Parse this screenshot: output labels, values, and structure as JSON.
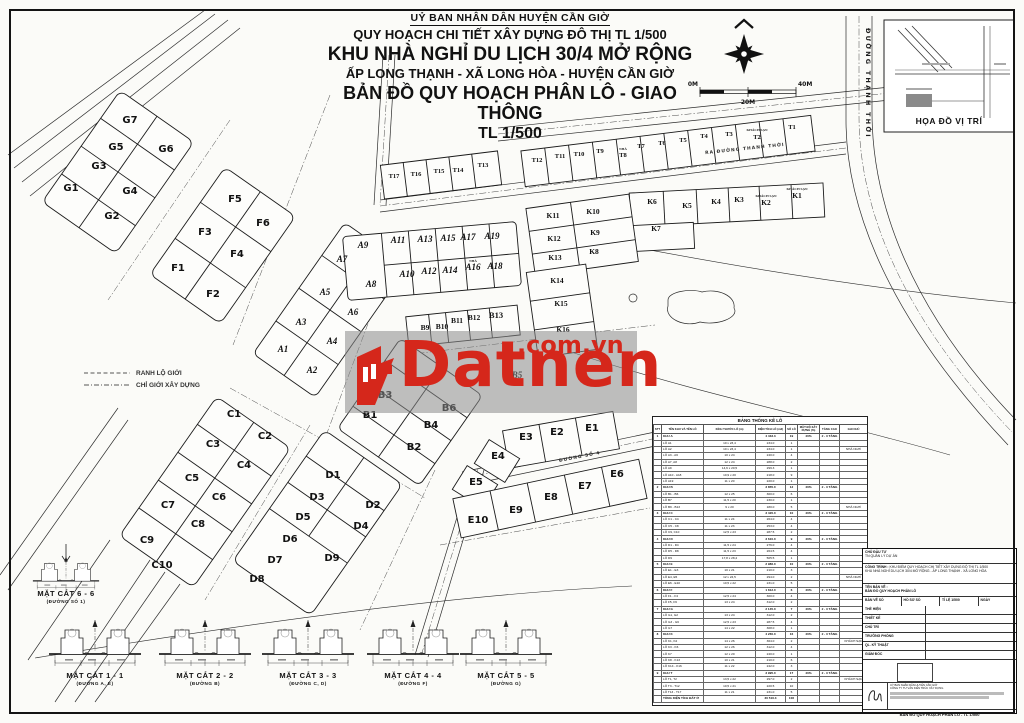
{
  "header": {
    "l1": "UỶ BAN NHÂN DÂN HUYỆN CẦN GIỜ",
    "l2": "QUY HOẠCH CHI TIẾT XÂY DỰNG ĐÔ THỊ TL 1/500",
    "l3": "KHU NHÀ NGHỈ DU LỊCH 30/4 MỞ RỘNG",
    "l4": "ẤP LONG THẠNH - XÃ LONG HÒA - HUYỆN CẦN GIỜ",
    "l5": "BẢN ĐỒ QUY HOẠCH PHÂN LÔ - GIAO THÔNG",
    "l6": "TL 1/500"
  },
  "scale": {
    "left": "0M",
    "mid": "20M",
    "right": "40M"
  },
  "inset": {
    "title": "HỌA ĐỒ VỊ TRÍ"
  },
  "legend": {
    "items": [
      "RANH LỘ GIỚI",
      "CHỈ GIỚI XÂY DỰNG"
    ]
  },
  "watermark": {
    "brand": "Datnen",
    "suffix": ".com.vn",
    "color": "#d5271b"
  },
  "map": {
    "roads": {
      "v": "ĐƯỜNG THẠNH THỚI",
      "top": "RA ĐƯỜNG THANH THỚI",
      "s4": "ĐƯỜNG SỐ 4"
    },
    "notes": [
      {
        "t": "KHÁCH SẠN",
        "x": 757,
        "y": 131
      },
      {
        "t": "KHÁCH SẠN",
        "x": 766,
        "y": 197
      },
      {
        "t": "KHÁCH SẠN",
        "x": 797,
        "y": 190
      },
      {
        "t": "NHÀ",
        "x": 623,
        "y": 150
      },
      {
        "t": "NHÀ",
        "x": 473,
        "y": 262
      }
    ],
    "lots": [
      {
        "t": "G1",
        "x": 71,
        "y": 191
      },
      {
        "t": "G2",
        "x": 112,
        "y": 219
      },
      {
        "t": "G3",
        "x": 99,
        "y": 169
      },
      {
        "t": "G4",
        "x": 130,
        "y": 194
      },
      {
        "t": "G5",
        "x": 116,
        "y": 150
      },
      {
        "t": "G6",
        "x": 166,
        "y": 152
      },
      {
        "t": "G7",
        "x": 130,
        "y": 123
      },
      {
        "t": "F1",
        "x": 178,
        "y": 271
      },
      {
        "t": "F2",
        "x": 213,
        "y": 297
      },
      {
        "t": "F3",
        "x": 205,
        "y": 235
      },
      {
        "t": "F4",
        "x": 237,
        "y": 257
      },
      {
        "t": "F5",
        "x": 235,
        "y": 202
      },
      {
        "t": "F6",
        "x": 263,
        "y": 226
      },
      {
        "t": "A1",
        "x": 283,
        "y": 352,
        "c": "la"
      },
      {
        "t": "A2",
        "x": 312,
        "y": 373,
        "c": "la"
      },
      {
        "t": "A3",
        "x": 301,
        "y": 325,
        "c": "la"
      },
      {
        "t": "A4",
        "x": 332,
        "y": 344,
        "c": "la"
      },
      {
        "t": "A5",
        "x": 325,
        "y": 295,
        "c": "la"
      },
      {
        "t": "A6",
        "x": 353,
        "y": 315,
        "c": "la"
      },
      {
        "t": "A7",
        "x": 342,
        "y": 262,
        "c": "la"
      },
      {
        "t": "A8",
        "x": 371,
        "y": 287,
        "c": "la"
      },
      {
        "t": "A9",
        "x": 363,
        "y": 248,
        "c": "la"
      },
      {
        "t": "A10",
        "x": 407,
        "y": 277,
        "c": "la"
      },
      {
        "t": "A11",
        "x": 398,
        "y": 243,
        "c": "la"
      },
      {
        "t": "A12",
        "x": 429,
        "y": 274,
        "c": "la"
      },
      {
        "t": "A13",
        "x": 425,
        "y": 242,
        "c": "la"
      },
      {
        "t": "A14",
        "x": 450,
        "y": 273,
        "c": "la"
      },
      {
        "t": "A15",
        "x": 448,
        "y": 241,
        "c": "la"
      },
      {
        "t": "A16",
        "x": 473,
        "y": 270,
        "c": "la"
      },
      {
        "t": "A17",
        "x": 468,
        "y": 240,
        "c": "la"
      },
      {
        "t": "A18",
        "x": 495,
        "y": 269,
        "c": "la"
      },
      {
        "t": "A19",
        "x": 492,
        "y": 239,
        "c": "la"
      },
      {
        "t": "B1",
        "x": 370,
        "y": 418
      },
      {
        "t": "B2",
        "x": 414,
        "y": 450
      },
      {
        "t": "B3",
        "x": 385,
        "y": 398
      },
      {
        "t": "B4",
        "x": 431,
        "y": 428
      },
      {
        "t": "B5",
        "x": 517,
        "y": 378,
        "c": "la"
      },
      {
        "t": "B6",
        "x": 449,
        "y": 411
      },
      {
        "t": "B7",
        "x": 413,
        "y": 352,
        "c": "la"
      },
      {
        "t": "B9",
        "x": 425,
        "y": 330,
        "c": "lk"
      },
      {
        "t": "B10",
        "x": 442,
        "y": 329,
        "c": "lk"
      },
      {
        "t": "B11",
        "x": 457,
        "y": 323,
        "c": "lk"
      },
      {
        "t": "B12",
        "x": 474,
        "y": 320,
        "c": "lk"
      },
      {
        "t": "B13",
        "x": 496,
        "y": 318,
        "c": "lb13"
      },
      {
        "t": "C1",
        "x": 234,
        "y": 417
      },
      {
        "t": "C2",
        "x": 265,
        "y": 439
      },
      {
        "t": "C3",
        "x": 213,
        "y": 447
      },
      {
        "t": "C4",
        "x": 244,
        "y": 468
      },
      {
        "t": "C5",
        "x": 192,
        "y": 481
      },
      {
        "t": "C6",
        "x": 219,
        "y": 500
      },
      {
        "t": "C7",
        "x": 168,
        "y": 508
      },
      {
        "t": "C8",
        "x": 198,
        "y": 527
      },
      {
        "t": "C9",
        "x": 147,
        "y": 543
      },
      {
        "t": "C10",
        "x": 162,
        "y": 568
      },
      {
        "t": "D1",
        "x": 333,
        "y": 478
      },
      {
        "t": "D2",
        "x": 373,
        "y": 508
      },
      {
        "t": "D3",
        "x": 317,
        "y": 500
      },
      {
        "t": "D4",
        "x": 361,
        "y": 529
      },
      {
        "t": "D5",
        "x": 303,
        "y": 520
      },
      {
        "t": "D6",
        "x": 290,
        "y": 542
      },
      {
        "t": "D7",
        "x": 275,
        "y": 563
      },
      {
        "t": "D8",
        "x": 257,
        "y": 582
      },
      {
        "t": "D9",
        "x": 332,
        "y": 561
      },
      {
        "t": "E1",
        "x": 592,
        "y": 431
      },
      {
        "t": "E2",
        "x": 557,
        "y": 435
      },
      {
        "t": "E3",
        "x": 526,
        "y": 440
      },
      {
        "t": "E4",
        "x": 498,
        "y": 459
      },
      {
        "t": "E5",
        "x": 476,
        "y": 485
      },
      {
        "t": "E6",
        "x": 617,
        "y": 477
      },
      {
        "t": "E7",
        "x": 585,
        "y": 489
      },
      {
        "t": "E8",
        "x": 551,
        "y": 500
      },
      {
        "t": "E9",
        "x": 516,
        "y": 513
      },
      {
        "t": "E10",
        "x": 478,
        "y": 523
      },
      {
        "t": "K1",
        "x": 797,
        "y": 198,
        "c": "lk"
      },
      {
        "t": "K2",
        "x": 766,
        "y": 205,
        "c": "lk"
      },
      {
        "t": "K3",
        "x": 739,
        "y": 202,
        "c": "lk"
      },
      {
        "t": "K4",
        "x": 716,
        "y": 204,
        "c": "lk"
      },
      {
        "t": "K5",
        "x": 687,
        "y": 208,
        "c": "lk"
      },
      {
        "t": "K6",
        "x": 652,
        "y": 204,
        "c": "lk"
      },
      {
        "t": "K7",
        "x": 656,
        "y": 231,
        "c": "lk"
      },
      {
        "t": "K8",
        "x": 594,
        "y": 254,
        "c": "lk"
      },
      {
        "t": "K9",
        "x": 595,
        "y": 235,
        "c": "lk"
      },
      {
        "t": "K10",
        "x": 593,
        "y": 214,
        "c": "lk"
      },
      {
        "t": "K11",
        "x": 553,
        "y": 218,
        "c": "lk"
      },
      {
        "t": "K12",
        "x": 554,
        "y": 241,
        "c": "lk"
      },
      {
        "t": "K13",
        "x": 555,
        "y": 260,
        "c": "lk"
      },
      {
        "t": "K14",
        "x": 557,
        "y": 283,
        "c": "lk"
      },
      {
        "t": "K15",
        "x": 561,
        "y": 306,
        "c": "lk"
      },
      {
        "t": "K16",
        "x": 563,
        "y": 332,
        "c": "lk"
      },
      {
        "t": "T1",
        "x": 792,
        "y": 129,
        "c": "lt"
      },
      {
        "t": "T2",
        "x": 757,
        "y": 139,
        "c": "lt"
      },
      {
        "t": "T3",
        "x": 729,
        "y": 136,
        "c": "lt"
      },
      {
        "t": "T4",
        "x": 704,
        "y": 138,
        "c": "lt"
      },
      {
        "t": "T5",
        "x": 683,
        "y": 142,
        "c": "lt"
      },
      {
        "t": "T6",
        "x": 662,
        "y": 145,
        "c": "lt"
      },
      {
        "t": "T7",
        "x": 641,
        "y": 148,
        "c": "lt"
      },
      {
        "t": "T8",
        "x": 623,
        "y": 157,
        "c": "lt"
      },
      {
        "t": "T9",
        "x": 600,
        "y": 153,
        "c": "lt"
      },
      {
        "t": "T10",
        "x": 579,
        "y": 156,
        "c": "lt"
      },
      {
        "t": "T11",
        "x": 560,
        "y": 158,
        "c": "lt"
      },
      {
        "t": "T12",
        "x": 537,
        "y": 162,
        "c": "lt"
      },
      {
        "t": "T13",
        "x": 483,
        "y": 167,
        "c": "lt"
      },
      {
        "t": "T14",
        "x": 458,
        "y": 172,
        "c": "lt"
      },
      {
        "t": "T15",
        "x": 439,
        "y": 173,
        "c": "lt"
      },
      {
        "t": "T16",
        "x": 416,
        "y": 176,
        "c": "lt"
      },
      {
        "t": "T17",
        "x": 394,
        "y": 178,
        "c": "lt"
      }
    ]
  },
  "sections": [
    {
      "name": "MẶT CẮT 1 - 1",
      "road": "(ĐƯỜNG A, E)"
    },
    {
      "name": "MẶT CẮT 2 - 2",
      "road": "(ĐƯỜNG B)"
    },
    {
      "name": "MẶT CẮT 3 - 3",
      "road": "(ĐƯỜNG C, D)"
    },
    {
      "name": "MẶT CẮT 4 - 4",
      "road": "(ĐƯỜNG F)"
    },
    {
      "name": "MẶT CẮT 5 - 5",
      "road": "(ĐƯỜNG G)"
    },
    {
      "name": "MẶT CẮT 6 - 6",
      "road": "(ĐƯỜNG SỐ 1)"
    }
  ],
  "table": {
    "title": "BẢNG THỐNG KÊ LÔ",
    "headers": [
      "STT",
      "TÊN KHU VÀ TÊN LÔ",
      "KÍCH THƯỚC LÔ (m)",
      "DIỆN TÍCH LÔ (m2)",
      "SỐ LÔ",
      "MẬT ĐỘ XÂY DỰNG (%)",
      "TẦNG CAO",
      "GHI CHÚ"
    ],
    "rows": [
      {
        "g": 1,
        "c": [
          "1",
          "KHU A",
          "",
          "4 433.3",
          "19",
          "40%",
          "2 - 3 TẦNG",
          ""
        ]
      },
      {
        "c": [
          "",
          "LÔ A1",
          "10 x 23,4",
          "234.0",
          "1",
          "",
          "",
          ""
        ]
      },
      {
        "c": [
          "",
          "LÔ A2",
          "10 x 23,4",
          "234.0",
          "1",
          "",
          "",
          "NHÀ NGHỈ"
        ]
      },
      {
        "c": [
          "",
          "LÔ A3 - A6",
          "10 x 24",
          "240.0",
          "4",
          "",
          "",
          ""
        ]
      },
      {
        "c": [
          "",
          "LÔ A7, A8",
          "12 x 24",
          "288.0",
          "2",
          "",
          "",
          ""
        ]
      },
      {
        "c": [
          "",
          "LÔ A9",
          "14,6 x 20,5",
          "299.3",
          "1",
          "",
          "",
          ""
        ]
      },
      {
        "c": [
          "",
          "LÔ A10 - A18",
          "10,9 x 20",
          "218.0",
          "9",
          "",
          "",
          ""
        ]
      },
      {
        "c": [
          "",
          "LÔ A19",
          "11 x 20",
          "220.0",
          "1",
          "",
          "",
          ""
        ]
      },
      {
        "g": 1,
        "c": [
          "2",
          "KHU B",
          "",
          "3 855.0",
          "12",
          "40%",
          "2 - 3 TẦNG",
          ""
        ]
      },
      {
        "c": [
          "",
          "LÔ B1 - B6",
          "12 x 25",
          "300.0",
          "6",
          "",
          "",
          ""
        ]
      },
      {
        "c": [
          "",
          "LÔ B7",
          "11,5 x 20",
          "230.0",
          "1",
          "",
          "",
          ""
        ]
      },
      {
        "c": [
          "",
          "LÔ B9 - B13",
          "9 x 20",
          "180.0",
          "5",
          "",
          "",
          "NHÀ NGHỈ"
        ]
      },
      {
        "g": 1,
        "c": [
          "3",
          "KHU C",
          "",
          "3 420.0",
          "10",
          "40%",
          "2 - 3 TẦNG",
          ""
        ]
      },
      {
        "c": [
          "",
          "LÔ C1 - C4",
          "11 x 24",
          "264.0",
          "4",
          "",
          "",
          ""
        ]
      },
      {
        "c": [
          "",
          "LÔ C5 - C8",
          "11 x 23",
          "253.0",
          "4",
          "",
          "",
          ""
        ]
      },
      {
        "c": [
          "",
          "LÔ C9, C10",
          "12,5 x 23",
          "287.5",
          "2",
          "",
          "",
          ""
        ]
      },
      {
        "g": 1,
        "c": [
          "4",
          "KHU D",
          "",
          "3 610.0",
          "9",
          "40%",
          "2 - 3 TẦNG",
          ""
        ]
      },
      {
        "c": [
          "",
          "LÔ D1 - D4",
          "11,5 x 24",
          "276.0",
          "4",
          "",
          "",
          ""
        ]
      },
      {
        "c": [
          "",
          "LÔ D5 - D8",
          "11,5 x 23",
          "264.5",
          "4",
          "",
          "",
          ""
        ]
      },
      {
        "c": [
          "",
          "LÔ D9",
          "17,8 x 28,4",
          "505.5",
          "1",
          "",
          "",
          ""
        ]
      },
      {
        "g": 1,
        "c": [
          "5",
          "KHU E",
          "",
          "2 986.0",
          "10",
          "40%",
          "2 - 3 TẦNG",
          ""
        ]
      },
      {
        "c": [
          "",
          "LÔ E1 - E3",
          "10 x 21",
          "210.0",
          "3",
          "",
          "",
          ""
        ]
      },
      {
        "c": [
          "",
          "LÔ E4, E5",
          "12 x 24,5",
          "294.0",
          "2",
          "",
          "",
          "NHÀ NGHỈ"
        ]
      },
      {
        "c": [
          "",
          "LÔ E6 - E10",
          "10,5 x 22",
          "231.0",
          "5",
          "",
          "",
          ""
        ]
      },
      {
        "g": 1,
        "c": [
          "6",
          "KHU F",
          "",
          "1 812.0",
          "6",
          "40%",
          "2 - 3 TẦNG",
          ""
        ]
      },
      {
        "c": [
          "",
          "LÔ F1 - F4",
          "12,5 x 24",
          "300.0",
          "4",
          "",
          "",
          ""
        ]
      },
      {
        "c": [
          "",
          "LÔ F5, F6",
          "13 x 24",
          "312.0",
          "2",
          "",
          "",
          ""
        ]
      },
      {
        "g": 1,
        "c": [
          "7",
          "KHU G",
          "",
          "2 145.0",
          "7",
          "40%",
          "2 - 3 TẦNG",
          ""
        ]
      },
      {
        "c": [
          "",
          "LÔ G1, G2",
          "13 x 24",
          "312.0",
          "2",
          "",
          "",
          ""
        ]
      },
      {
        "c": [
          "",
          "LÔ G3 - G6",
          "12,5 x 23",
          "287.5",
          "4",
          "",
          "",
          ""
        ]
      },
      {
        "c": [
          "",
          "LÔ G7",
          "14 x 22",
          "308.0",
          "1",
          "",
          "",
          ""
        ]
      },
      {
        "g": 1,
        "c": [
          "8",
          "KHU K",
          "",
          "4 260.0",
          "16",
          "40%",
          "2 - 3 TẦNG",
          ""
        ]
      },
      {
        "c": [
          "",
          "LÔ K1, K2",
          "14 x 26",
          "364.0",
          "2",
          "",
          "",
          "KHÁCH SẠN"
        ]
      },
      {
        "c": [
          "",
          "LÔ K3 - K6",
          "12 x 26",
          "312.0",
          "4",
          "",
          "",
          ""
        ]
      },
      {
        "c": [
          "",
          "LÔ K7",
          "12 x 20",
          "240.0",
          "1",
          "",
          "",
          ""
        ]
      },
      {
        "c": [
          "",
          "LÔ K8 - K13",
          "10 x 21",
          "210.0",
          "6",
          "",
          "",
          ""
        ]
      },
      {
        "c": [
          "",
          "LÔ K14 - K16",
          "11 x 22",
          "242.0",
          "3",
          "",
          "",
          ""
        ]
      },
      {
        "g": 1,
        "c": [
          "9",
          "KHU T",
          "",
          "3 995.0",
          "17",
          "40%",
          "2 - 3 TẦNG",
          ""
        ]
      },
      {
        "c": [
          "",
          "LÔ T1, T2",
          "13,5 x 22",
          "297.0",
          "2",
          "",
          "",
          "KHÁCH SẠN"
        ]
      },
      {
        "c": [
          "",
          "LÔ T3 - T12",
          "10,5 x 21",
          "220.5",
          "10",
          "",
          "",
          ""
        ]
      },
      {
        "c": [
          "",
          "LÔ T13 - T17",
          "11 x 21",
          "231.0",
          "5",
          "",
          "",
          ""
        ]
      },
      {
        "g": 1,
        "c": [
          "",
          "TỔNG DIỆN TÍCH ĐẤT Ở",
          "",
          "30 516.3",
          "106",
          "",
          "",
          ""
        ]
      }
    ]
  },
  "sheet": {
    "owner_label": "CHỦ ĐẦU TƯ",
    "owner": "TN QUẢN LÝ DỰ ÁN",
    "project_label": "CÔNG TRÌNH :",
    "project1": "KHU ĐIỂM QUY HOẠCH CHI TIẾT XÂY DỰNG ĐÔ THỊ TL 1/500",
    "project2": "KHU NHÀ NGHỈ DU LỊCH 30/4 MỞ RỘNG - ẤP LONG THẠNH - XÃ LONG HÒA",
    "drawing_label": "TÊN BẢN VẼ :",
    "drawing": "BẢN ĐỒ QUY HOẠCH PHÂN LÔ",
    "meta": [
      "BẢN VẼ SỐ",
      "HỒ SƠ SỐ",
      "TỈ LỆ  1/500",
      "NGÀY"
    ],
    "sign_rows": [
      "THỂ HIỆN",
      "THIẾT KẾ",
      "CHỦ TRÌ",
      "TRƯỞNG PHÒNG",
      "QL. KỸ THUẬT",
      "GIÁM ĐỐC"
    ],
    "agency1": "UỶ BAN NHÂN DÂN HUYỆN CẦN GIỜ",
    "agency2": "CÔNG TY TƯ VẤN KIẾN TRÚC XÂY DỰNG",
    "footer": "BẢN ĐỒ QUY HOẠCH PHÂN LÔ - TL 1/500"
  }
}
